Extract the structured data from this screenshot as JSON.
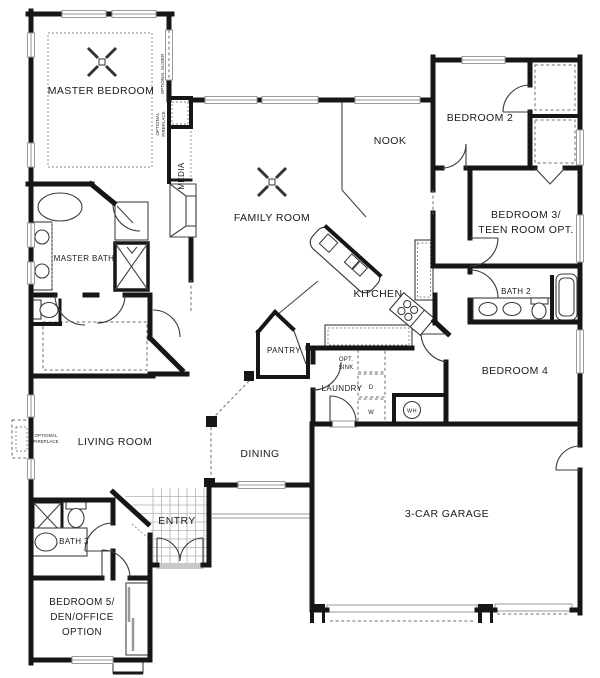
{
  "plan": {
    "title": "single-story floor plan",
    "rooms": {
      "master_bedroom": "MASTER BEDROOM",
      "family_room": "FAMILY ROOM",
      "nook": "NOOK",
      "bedroom2": "BEDROOM 2",
      "bedroom3_line1": "BEDROOM 3/",
      "bedroom3_line2": "TEEN ROOM OPT.",
      "master_bath": "MASTER BATH",
      "kitchen": "KITCHEN",
      "bath2": "BATH 2",
      "bedroom4": "BEDROOM 4",
      "pantry": "PANTRY",
      "laundry": "LAUNDRY",
      "living_room": "LIVING ROOM",
      "dining": "DINING",
      "entry": "ENTRY",
      "bath3": "BATH 3",
      "bedroom5_line1": "BEDROOM 5/",
      "bedroom5_line2": "DEN/OFFICE",
      "bedroom5_line3": "OPTION",
      "garage": "3-CAR GARAGE"
    },
    "annotations": {
      "media": "MEDIA",
      "optional_slider": "OPTIONAL SLIDER",
      "optional_fireplace_master_line1": "OPTIONAL",
      "optional_fireplace_master_line2": "FIREPLACE",
      "optional_fireplace_living_line1": "OPTIONAL",
      "optional_fireplace_living_line2": "FIREPLACE",
      "opt_sink_line1": "OPT.",
      "opt_sink_line2": "SINK",
      "dryer": "D",
      "washer": "W",
      "water_heater": "WH"
    }
  },
  "colors": {
    "wall": "#161616",
    "thin_line": "#444444",
    "window": "#9a9a9a",
    "dashed": "#6e6e6e",
    "background": "#ffffff"
  }
}
